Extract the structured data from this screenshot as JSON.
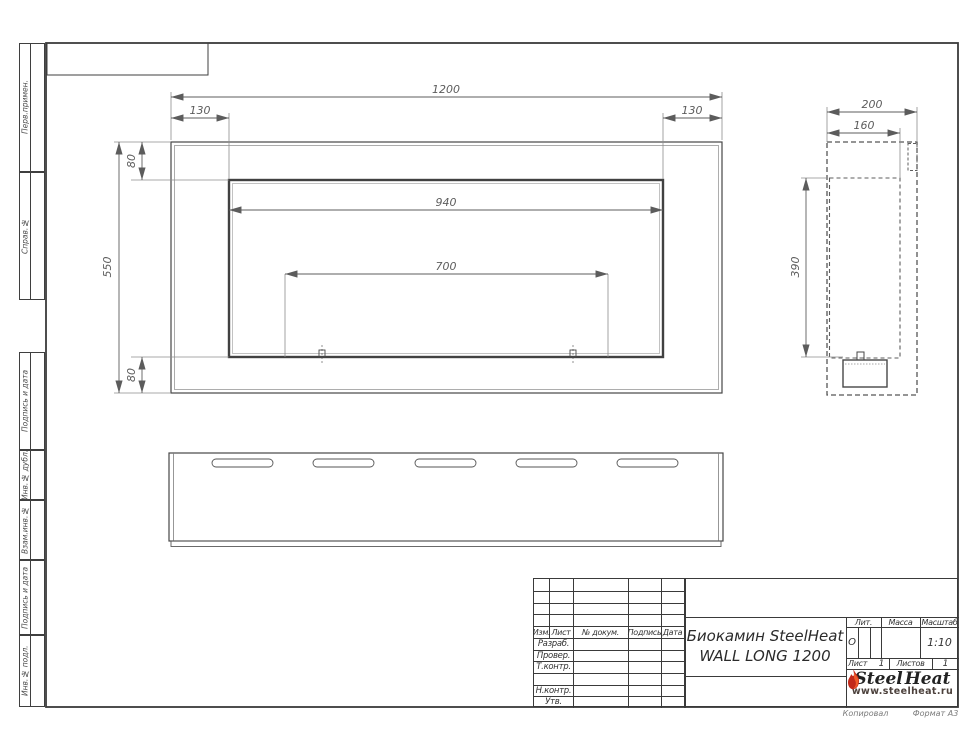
{
  "frame": {
    "side_labels": [
      "Перв.примен.",
      "Справ.№",
      "Подпись и дата",
      "Инв.№ дубл.",
      "Взам.инв.№",
      "Подпись и дата",
      "Инв.№ подл."
    ]
  },
  "dims": {
    "front_width": "1200",
    "front_left_offset": "130",
    "front_right_offset": "130",
    "front_top_offset": "80",
    "front_height": "550",
    "front_bottom_offset": "80",
    "opening_width": "940",
    "burner_length": "700",
    "side_depth": "200",
    "side_inner_depth": "160",
    "side_opening_height": "390"
  },
  "title_block": {
    "header_cols": [
      "Изм.",
      "Лист",
      "№ докум.",
      "Подпись",
      "Дата"
    ],
    "rows": [
      "Разраб.",
      "Провер.",
      "Т.контр.",
      "",
      "Н.контр.",
      "Утв."
    ],
    "product_line1": "Биокамин SteelHeat",
    "product_line2": "WALL LONG 1200",
    "lit_label": "Лит.",
    "mass_label": "Масса",
    "scale_label": "Масштаб",
    "lit_value": "О",
    "scale_value": "1:10",
    "sheet_label": "Лист",
    "sheet_value": "1",
    "sheets_label": "Листов",
    "sheets_value": "1",
    "logo_steel": "Steel",
    "logo_heat": "Heat",
    "logo_url": "www.steelheat.ru"
  },
  "footer": {
    "copied": "Копировал",
    "format": "Формат А3"
  },
  "colors": {
    "line": "#474747",
    "dim": "#5c5c5c",
    "flame_dark": "#c2291a",
    "flame_bright": "#ef5a28"
  }
}
